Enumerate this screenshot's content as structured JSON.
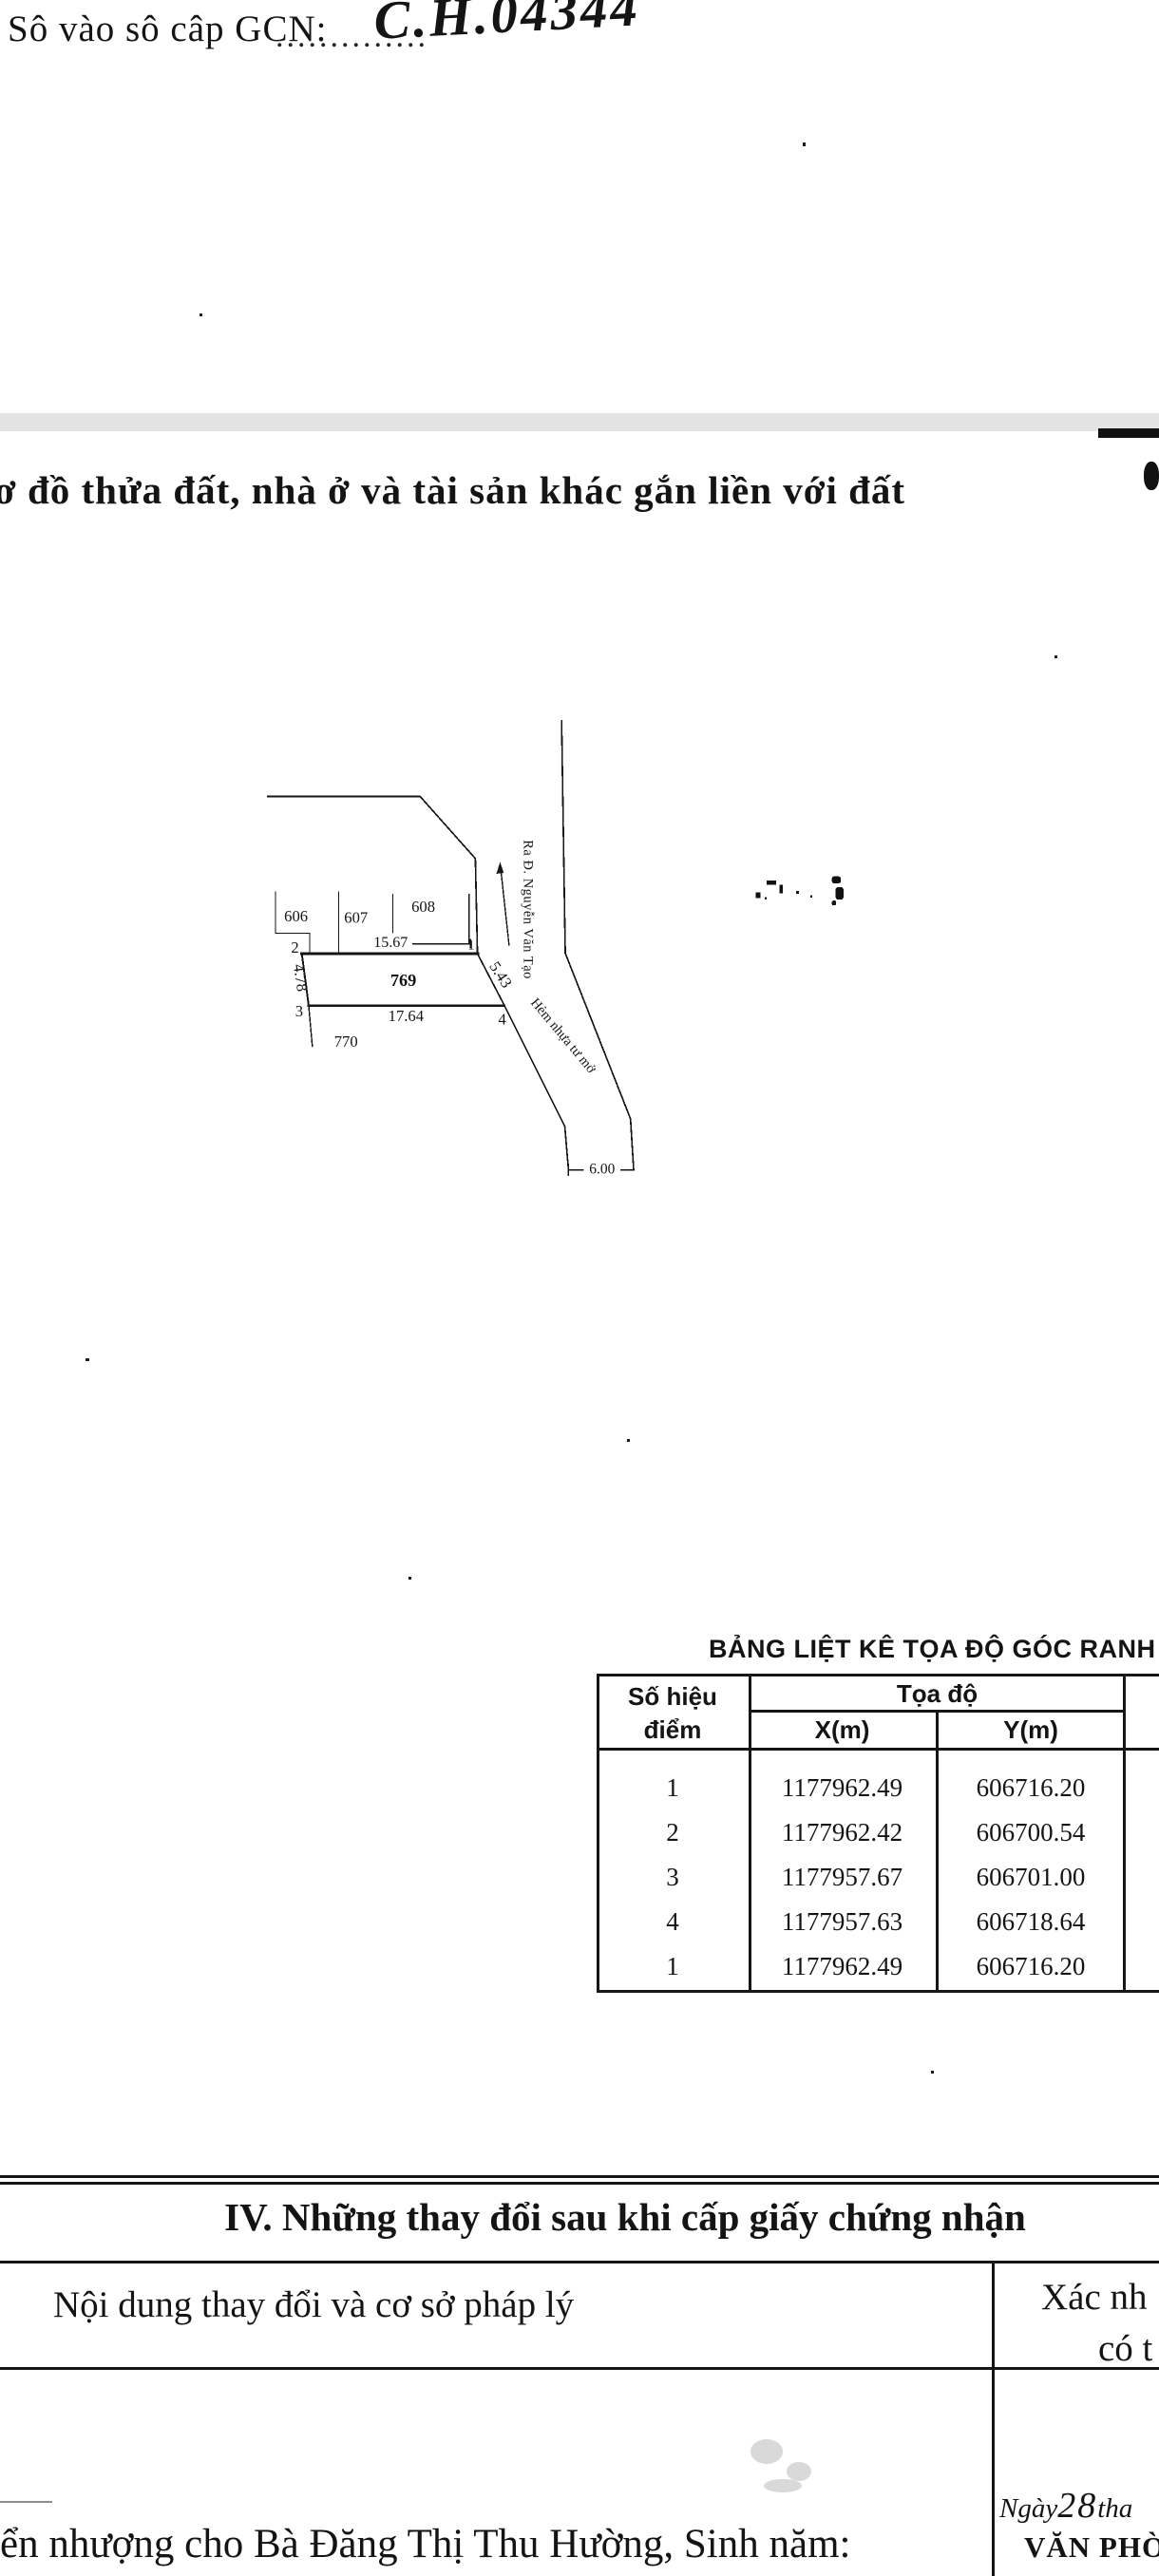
{
  "header": {
    "gcn_label": "Sô vào sô câp GCN:",
    "gcn_dots": "..............",
    "gcn_number": "C.H.04344"
  },
  "title": {
    "text": "ơ đồ thửa đất, nhà ở và tài sản khác gắn liền với đất"
  },
  "map": {
    "parcel_606": "606",
    "parcel_607": "607",
    "parcel_608": "608",
    "parcel_769": "769",
    "parcel_770": "770",
    "point_1": "1",
    "point_2": "2",
    "point_3": "3",
    "point_4": "4",
    "dim_top": "15.67",
    "dim_bottom": "17.64",
    "dim_left": "4.78",
    "dim_right": "5.43",
    "dim_road_width": "6.00",
    "road_main": "Ra Đ. Nguyễn Văn Tạo",
    "road_alley": "Hẻm nhựa tư mở"
  },
  "coord_table": {
    "title": "BẢNG LIỆT KÊ TỌA ĐỘ GÓC RANH",
    "header_point_line1": "Số hiệu",
    "header_point_line2": "điểm",
    "header_coord": "Tọa độ",
    "header_x": "X(m)",
    "header_y": "Y(m)",
    "rows": [
      {
        "n": "1",
        "x": "1177962.49",
        "y": "606716.20"
      },
      {
        "n": "2",
        "x": "1177962.42",
        "y": "606700.54"
      },
      {
        "n": "3",
        "x": "1177957.67",
        "y": "606701.00"
      },
      {
        "n": "4",
        "x": "1177957.63",
        "y": "606718.64"
      },
      {
        "n": "1",
        "x": "1177962.49",
        "y": "606716.20"
      }
    ]
  },
  "section_iv": {
    "title": "IV. Những thay đổi sau khi cấp giấy chứng nhận",
    "left_header": "Nội dung thay đổi và cơ sở pháp lý",
    "right_header_line1": "Xác nh",
    "right_header_line2": "có t"
  },
  "footer": {
    "date_prefix": "Ngày",
    "date_day": "28",
    "date_suffix": "tha",
    "office": "VĂN PHÒNG Đ",
    "transfer_text": "ển nhượng cho Bà Đăng Thị Thu Hường, Sinh năm:"
  },
  "colors": {
    "ink": "#141414",
    "band_gray": "#e3e3e3",
    "paper": "#ffffff"
  }
}
